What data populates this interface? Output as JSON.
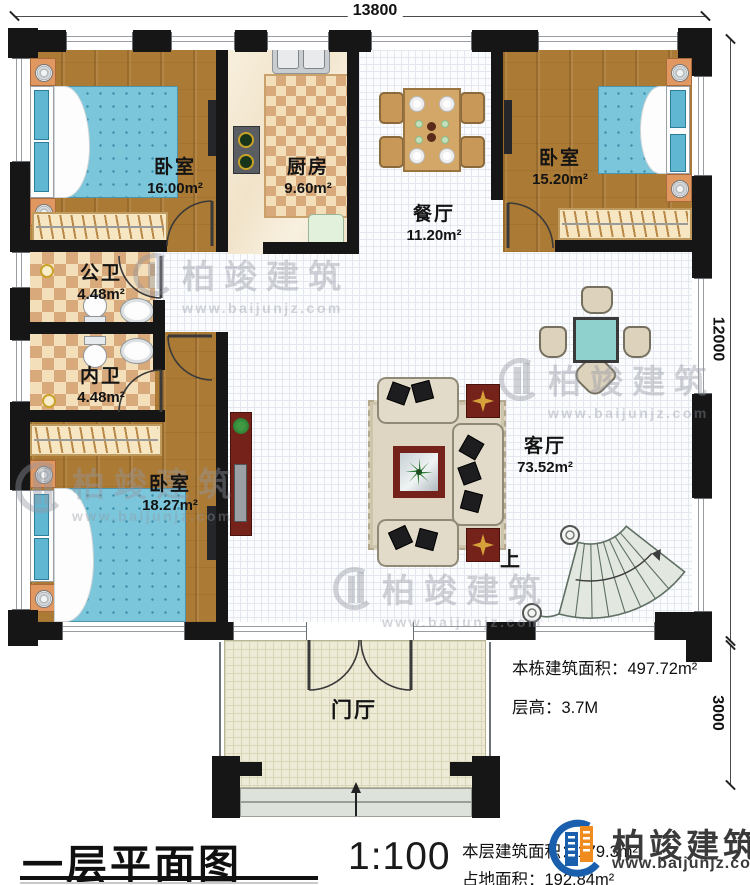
{
  "plan": {
    "title": "一层平面图",
    "scale": "1:100",
    "floor_area_label": "本层建筑面积：",
    "floor_area_value": "179.3m²",
    "footprint_label": "占地面积：",
    "footprint_value": "192.84m²",
    "total_area_label": "本栋建筑面积：",
    "total_area_value": "497.72m²",
    "floor_height_label": "层高：",
    "floor_height_value": "3.7M"
  },
  "dimensions": {
    "top": "13800",
    "right_upper": "12000",
    "right_lower": "3000"
  },
  "rooms": [
    {
      "key": "bedroom-1",
      "name": "卧室",
      "area": "16.00m²"
    },
    {
      "key": "kitchen",
      "name": "厨房",
      "area": "9.60m²"
    },
    {
      "key": "dining",
      "name": "餐厅",
      "area": "11.20m²"
    },
    {
      "key": "bedroom-2",
      "name": "卧室",
      "area": "15.20m²"
    },
    {
      "key": "public-bath",
      "name": "公卫",
      "area": "4.48m²"
    },
    {
      "key": "private-bath",
      "name": "内卫",
      "area": "4.48m²"
    },
    {
      "key": "bedroom-3",
      "name": "卧室",
      "area": "18.27m²"
    },
    {
      "key": "living",
      "name": "客厅",
      "area": "73.52m²"
    },
    {
      "key": "foyer",
      "name": "门厅",
      "area": ""
    }
  ],
  "stairs": {
    "direction_label": "上"
  },
  "brand": {
    "name": "柏竣建筑",
    "website": "www.baijunjz.com"
  },
  "watermark": {
    "text": "柏竣建筑",
    "website": "www.baijunjz.com"
  },
  "colors": {
    "wall": "#161616",
    "wood": "#ab7a35",
    "mattress_blue": "#7cc6db",
    "accent_blue": "#1a5fae",
    "accent_orange": "#f08c1e",
    "table_teal": "#8fd2cd",
    "cabinet_red": "#74221a"
  }
}
